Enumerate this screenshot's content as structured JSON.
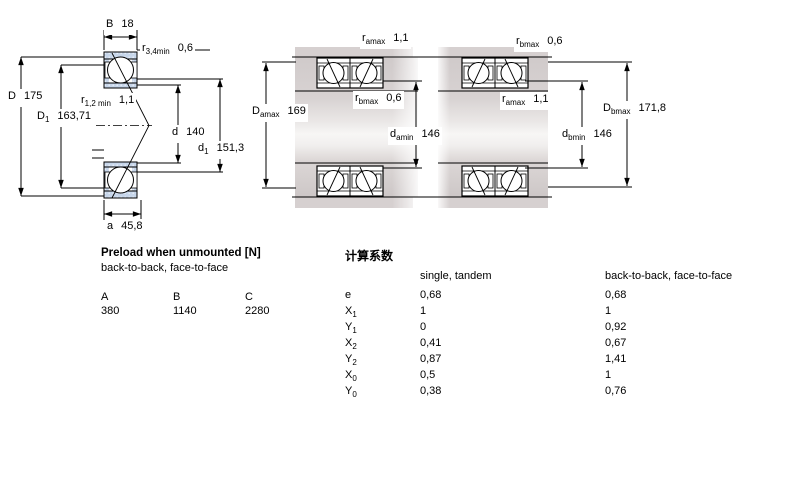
{
  "drawing": {
    "left_view": {
      "B": {
        "base": "B",
        "value": "18"
      },
      "r34": {
        "base": "r",
        "sub": "3,4min",
        "value": "0,6"
      },
      "D": {
        "base": "D",
        "value": "175"
      },
      "r12": {
        "base": "r",
        "sub": "1,2 min",
        "value": "1,1"
      },
      "D1": {
        "base": "D",
        "sub": "1",
        "value": "163,71"
      },
      "d": {
        "base": "d",
        "value": "140"
      },
      "d1": {
        "base": "d",
        "sub": "1",
        "value": "151,3"
      },
      "a": {
        "base": "a",
        "value": "45,8"
      }
    },
    "middle_view": {
      "ramax": {
        "base": "r",
        "sub": "amax",
        "value": "1,1"
      },
      "Damax": {
        "base": "D",
        "sub": "amax",
        "value": "169"
      },
      "rbmax": {
        "base": "r",
        "sub": "bmax",
        "value": "0,6"
      },
      "damin": {
        "base": "d",
        "sub": "amin",
        "value": "146"
      }
    },
    "right_view": {
      "rbmax": {
        "base": "r",
        "sub": "bmax",
        "value": "0,6"
      },
      "ramax": {
        "base": "r",
        "sub": "amax",
        "value": "1,1"
      },
      "Dbmax": {
        "base": "D",
        "sub": "bmax",
        "value": "171,8"
      },
      "dbmin": {
        "base": "d",
        "sub": "bmin",
        "value": "146"
      }
    },
    "colors": {
      "bearing_fill": "#c7d6ea",
      "steel_gray": "#d6d0d0",
      "line": "#000000"
    }
  },
  "preload_table": {
    "title": "Preload when unmounted [N]",
    "subtitle": "back-to-back, face-to-face",
    "columns": [
      "A",
      "B",
      "C"
    ],
    "values": [
      "380",
      "1140",
      "2280"
    ]
  },
  "factors_table": {
    "title": "计算系数",
    "columns": [
      "single, tandem",
      "back-to-back, face-to-face"
    ],
    "rows": [
      {
        "base": "e",
        "sub": "",
        "c1": "0,68",
        "c2": "0,68"
      },
      {
        "base": "X",
        "sub": "1",
        "c1": "1",
        "c2": "1"
      },
      {
        "base": "Y",
        "sub": "1",
        "c1": "0",
        "c2": "0,92"
      },
      {
        "base": "X",
        "sub": "2",
        "c1": "0,41",
        "c2": "0,67"
      },
      {
        "base": "Y",
        "sub": "2",
        "c1": "0,87",
        "c2": "1,41"
      },
      {
        "base": "X",
        "sub": "0",
        "c1": "0,5",
        "c2": "1"
      },
      {
        "base": "Y",
        "sub": "0",
        "c1": "0,38",
        "c2": "0,76"
      }
    ]
  }
}
